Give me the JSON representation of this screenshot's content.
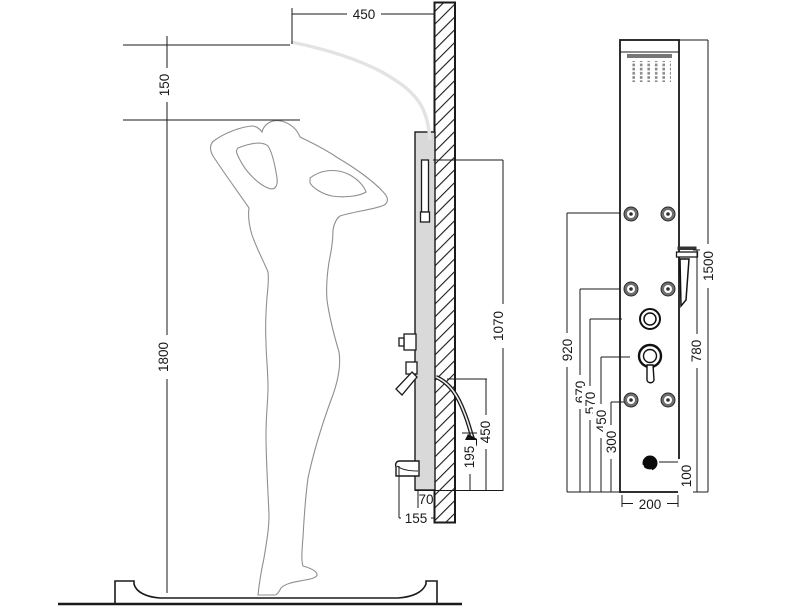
{
  "side_view": {
    "dim_arm_reach": "450",
    "dim_head_clearance": "150",
    "dim_overall_height": "1800",
    "dim_rail_top_height": "1070",
    "dim_hose_height": "450",
    "dim_outlet_height": "195",
    "dim_panel_depth": "70",
    "dim_spout_projection": "155"
  },
  "front_view": {
    "dim_panel_height": "1500",
    "dim_top_jets_height": "920",
    "dim_hand_shower_height": "780",
    "dim_mid_jets_height": "670",
    "dim_diverter_height": "570",
    "dim_mixer_height": "450",
    "dim_low_jets_height": "300",
    "dim_spout_height": "100",
    "dim_panel_width": "200"
  },
  "colors": {
    "line": "#1a1a1a",
    "panel_fill": "#d9d9d9",
    "figure_line": "#8f8f8f",
    "metal_dark": "#6e6e6e"
  }
}
